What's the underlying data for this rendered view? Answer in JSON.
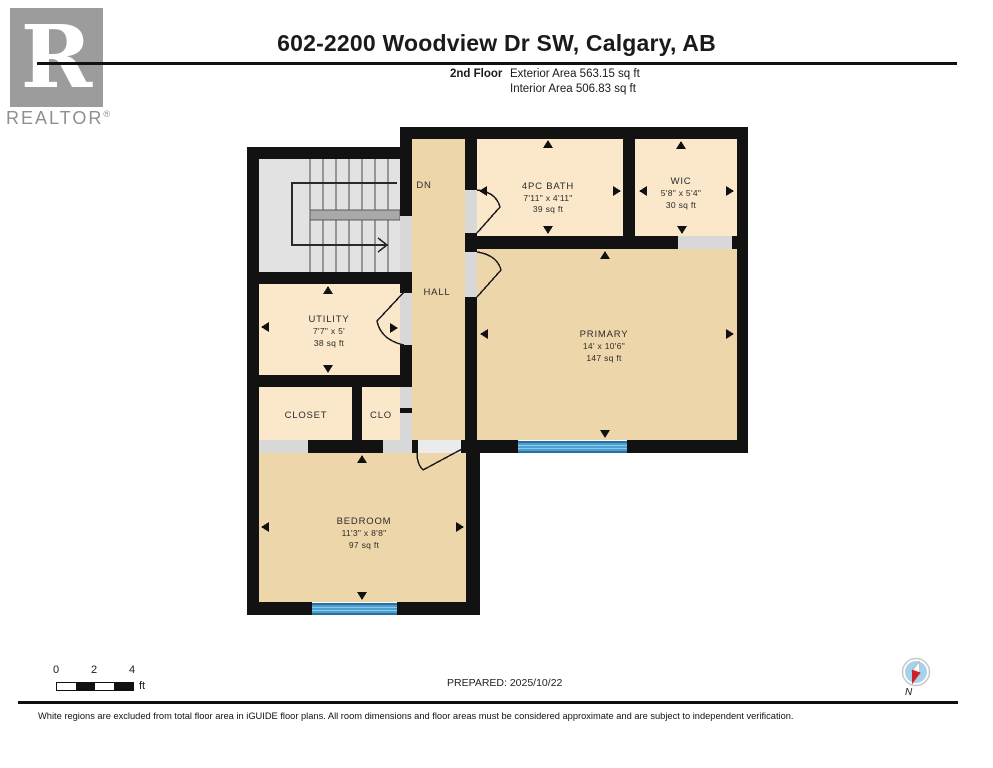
{
  "header": {
    "logo_letter": "R",
    "logo_text": "REALTOR",
    "logo_registered": "®",
    "title": "602-2200 Woodview Dr SW, Calgary, AB",
    "floor_label": "2nd Floor",
    "exterior_area": "Exterior Area 563.15 sq ft",
    "interior_area": "Interior Area 506.83 sq ft"
  },
  "floorplan": {
    "rooms": {
      "stairs": {
        "label": "DN"
      },
      "hall": {
        "label": "HALL"
      },
      "bath": {
        "name": "4PC BATH",
        "dims": "7'11\" x 4'11\"",
        "area": "39 sq ft"
      },
      "wic": {
        "name": "WIC",
        "dims": "5'8\" x 5'4\"",
        "area": "30 sq ft"
      },
      "primary": {
        "name": "PRIMARY",
        "dims": "14' x 10'6\"",
        "area": "147 sq ft"
      },
      "utility": {
        "name": "UTILITY",
        "dims": "7'7\" x 5'",
        "area": "38 sq ft"
      },
      "closet": {
        "name": "CLOSET"
      },
      "clo": {
        "name": "CLO"
      },
      "bedroom": {
        "name": "BEDROOM",
        "dims": "11'3\" x 8'8\"",
        "area": "97 sq ft"
      }
    },
    "colors": {
      "wall": "#121212",
      "room_light": "#fbe8cb",
      "room_dark": "#eed6ab",
      "stairs_fill": "#e2e2e2",
      "stair_landing": "#a9a9a9",
      "opening_gray": "#d8d8d8",
      "window_blue": "#4d9fd0",
      "window_edge": "#26719f"
    }
  },
  "footer": {
    "scale": {
      "ticks": [
        "0",
        "2",
        "4"
      ],
      "unit": "ft"
    },
    "prepared": "PREPARED: 2025/10/22",
    "compass": {
      "label": "N",
      "disc": "#a6d2ed",
      "needle_red": "#ce2127",
      "needle_white": "#ffffff"
    },
    "disclaimer": "White regions are excluded from total floor area in iGUIDE floor plans. All room dimensions and floor areas must be considered approximate and are subject to independent verification."
  }
}
